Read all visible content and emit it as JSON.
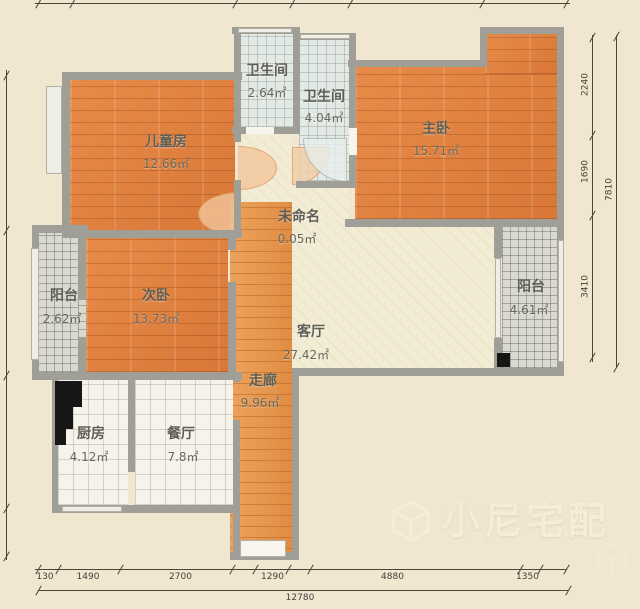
{
  "rooms": {
    "bath1": {
      "name": "卫生间",
      "area": "2.64㎡"
    },
    "bath2": {
      "name": "卫生间",
      "area": "4.04㎡"
    },
    "master": {
      "name": "主卧",
      "area": "15.71㎡"
    },
    "children": {
      "name": "儿童房",
      "area": "12.66㎡"
    },
    "unnamed": {
      "name": "未命名",
      "area": "0.05㎡"
    },
    "second": {
      "name": "次卧",
      "area": "13.73㎡"
    },
    "living": {
      "name": "客厅",
      "area": "27.42㎡"
    },
    "corridor": {
      "name": "走廊",
      "area": "9.96㎡"
    },
    "kitchen": {
      "name": "厨房",
      "area": "4.12㎡"
    },
    "dining": {
      "name": "餐厅",
      "area": "7.8㎡"
    },
    "balcony_left": {
      "name": "阳台",
      "area": "2.62㎡"
    },
    "balcony_right": {
      "name": "阳台",
      "area": "4.61㎡"
    }
  },
  "dimensions": {
    "bottom_segments": [
      "130",
      "1490",
      "2700",
      "1290",
      "4880",
      "1350"
    ],
    "bottom_total": "12780",
    "right_segments": [
      "2240",
      "1690",
      "3410"
    ],
    "right_total": "7810"
  },
  "watermark": {
    "brand": "小尼宅配"
  },
  "colors": {
    "paper": "#f1e7d0",
    "wall": "#9f9f97",
    "wood_floor": "#e08140",
    "corridor_floor": "#e6954a",
    "living_floor": "#f3ecd5",
    "bath_tile": "#e3e9e5",
    "balcony_tile": "#d9d9d1",
    "kitchen_tile": "#f5f3ea"
  }
}
